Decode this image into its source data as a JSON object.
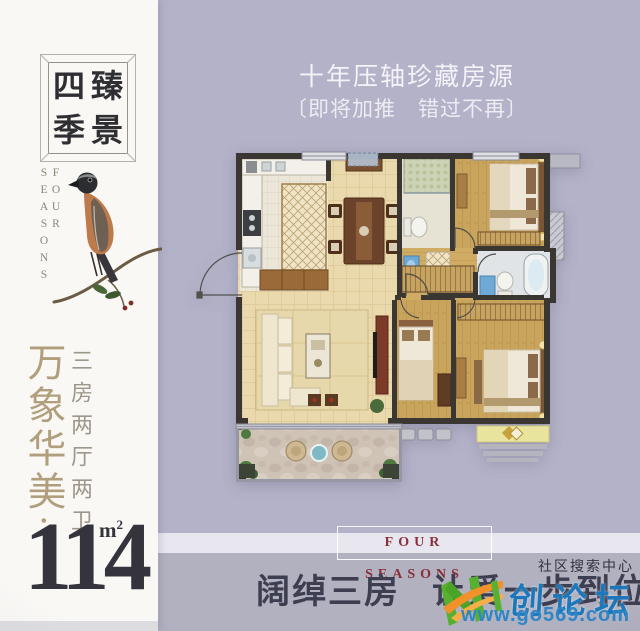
{
  "poster": {
    "brand": {
      "logo_characters": [
        "四",
        "臻",
        "季",
        "景"
      ],
      "brand_en_vertical": "FOUR SEASONS"
    },
    "left_panel": {
      "slogan_vertical": "万象华美·",
      "layout_vertical": "三房两厅两卫",
      "area_value": "114",
      "area_unit": "m",
      "area_unit_exponent": "2"
    },
    "promo": {
      "headline": "十年压轴珍藏房源",
      "subheadline": "〔即将加推　错过不再〕",
      "band_text": "FOUR SEASONS",
      "tagline_part1": "阔绰三房",
      "tagline_part2": "让爱一步到位"
    },
    "watermark": {
      "community_label": "社区搜索中心",
      "site_name": "创论坛",
      "site_url": "www.go569.com"
    },
    "colors": {
      "background_lavender": "#b3b2c8",
      "panel_white": "#f9f8f5",
      "band": "#e8e7ef",
      "band_text_red": "#8c2e3a",
      "accent_gold": "#b19e7d",
      "ink": "#35343d",
      "watermark_blue": "#2e86c6",
      "watermark_green": "#57b02f",
      "watermark_orange": "#f0912a"
    }
  }
}
